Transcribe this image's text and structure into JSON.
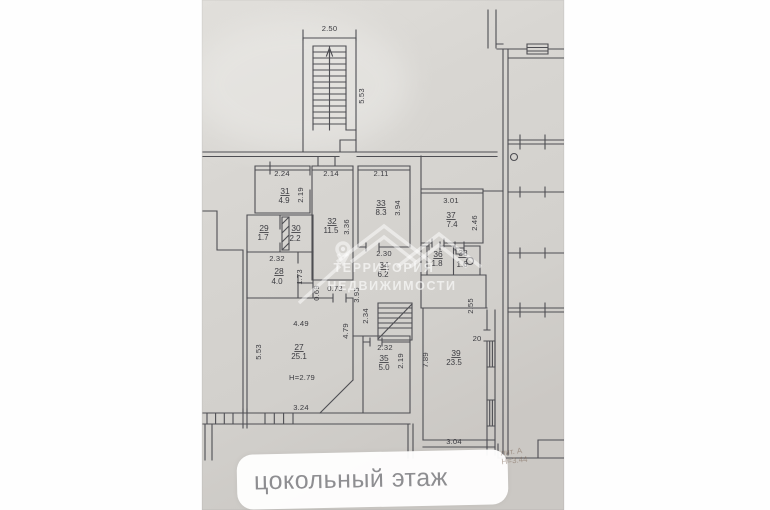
{
  "floor_label": "цокольный этаж",
  "watermark": {
    "line1": "ТЕРРИТОРИЯ",
    "line2": "НЕДВИЖИМОСТИ"
  },
  "handwritten_note": {
    "line1": "лит. А",
    "line2": "Н=3.44"
  },
  "plan": {
    "stairwell": {
      "width": "2.50",
      "depth": "5.53"
    },
    "inner_stair_dim": "2.34",
    "niche": {
      "h": "0.69",
      "w": "0.73"
    },
    "rooms": [
      {
        "number": "31",
        "area": "4.9",
        "dim_top": "2.24",
        "dim_side": "2.19"
      },
      {
        "number": "29",
        "area": "1.7"
      },
      {
        "number": "30",
        "area": "2.2"
      },
      {
        "number": "28",
        "area": "4.0",
        "dim_top": "2.32",
        "dim_side": "1.73"
      },
      {
        "number": "32",
        "area": "11.5",
        "dim_top": "2.14",
        "dim_side": "3.36"
      },
      {
        "number": "33",
        "area": "8.3",
        "dim_top": "2.11",
        "dim_side": "3.94"
      },
      {
        "number": "37",
        "area": "7.4",
        "dim_top": "3.01",
        "dim_side": "2.46"
      },
      {
        "number": "34",
        "area": "6.2",
        "dim_top": "2.30",
        "dim_side": "3.95"
      },
      {
        "number": "36",
        "area": "1.8"
      },
      {
        "number": "38",
        "area": "1.6"
      },
      {
        "number": "35",
        "area": "5.0",
        "dim_top": "2.32",
        "dim_side": "2.19"
      },
      {
        "number": "27",
        "area": "25.1",
        "dim_top": "4.49",
        "dim_left": "5.53",
        "dim_right": "4.79",
        "dim_bottom": "3.24",
        "ceiling_height": "Н=2.79"
      },
      {
        "number": "39",
        "area": "23.5",
        "dim_left": "7.89",
        "dim_bottom": "3.04",
        "dim_top": "2.55",
        "door_width": "20"
      }
    ]
  },
  "colors": {
    "paper": "#d6d4d1",
    "ink": "#4e4e53",
    "label_text": "#8e8e91"
  }
}
